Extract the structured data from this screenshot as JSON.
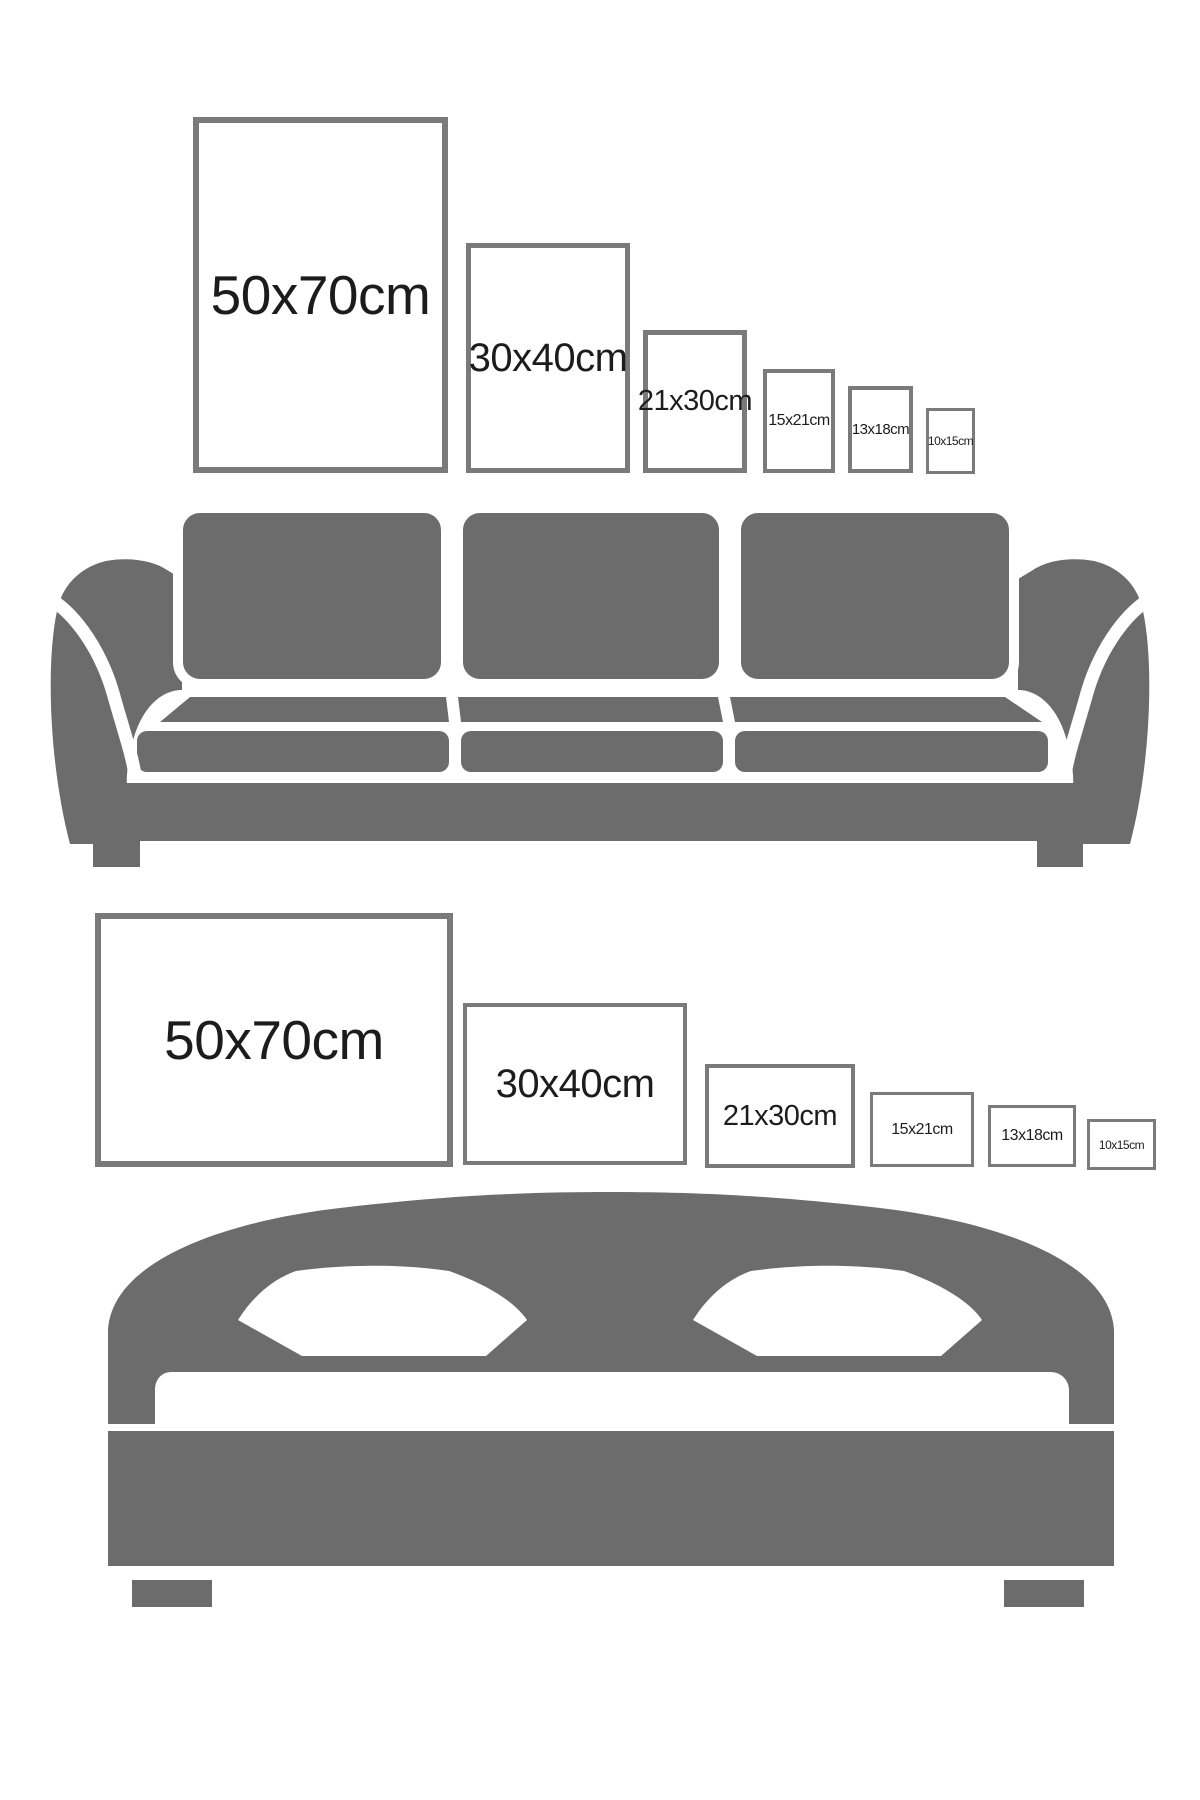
{
  "colors": {
    "background": "#ffffff",
    "furniture_gray": "#6c6c6c",
    "frame_border_gray": "#7a7a7a",
    "label_text": "#1c1c1c"
  },
  "sofa_wall": {
    "furniture": "sofa-illustration",
    "frames": [
      {
        "label": "50x70cm",
        "orientation": "portrait"
      },
      {
        "label": "30x40cm",
        "orientation": "portrait"
      },
      {
        "label": "21x30cm",
        "orientation": "portrait"
      },
      {
        "label": "15x21cm",
        "orientation": "portrait"
      },
      {
        "label": "13x18cm",
        "orientation": "portrait"
      },
      {
        "label": "10x15cm",
        "orientation": "portrait"
      }
    ]
  },
  "bed_wall": {
    "furniture": "bed-illustration",
    "frames": [
      {
        "label": "50x70cm",
        "orientation": "landscape"
      },
      {
        "label": "30x40cm",
        "orientation": "landscape"
      },
      {
        "label": "21x30cm",
        "orientation": "landscape"
      },
      {
        "label": "15x21cm",
        "orientation": "landscape"
      },
      {
        "label": "13x18cm",
        "orientation": "landscape"
      },
      {
        "label": "10x15cm",
        "orientation": "landscape"
      }
    ]
  }
}
